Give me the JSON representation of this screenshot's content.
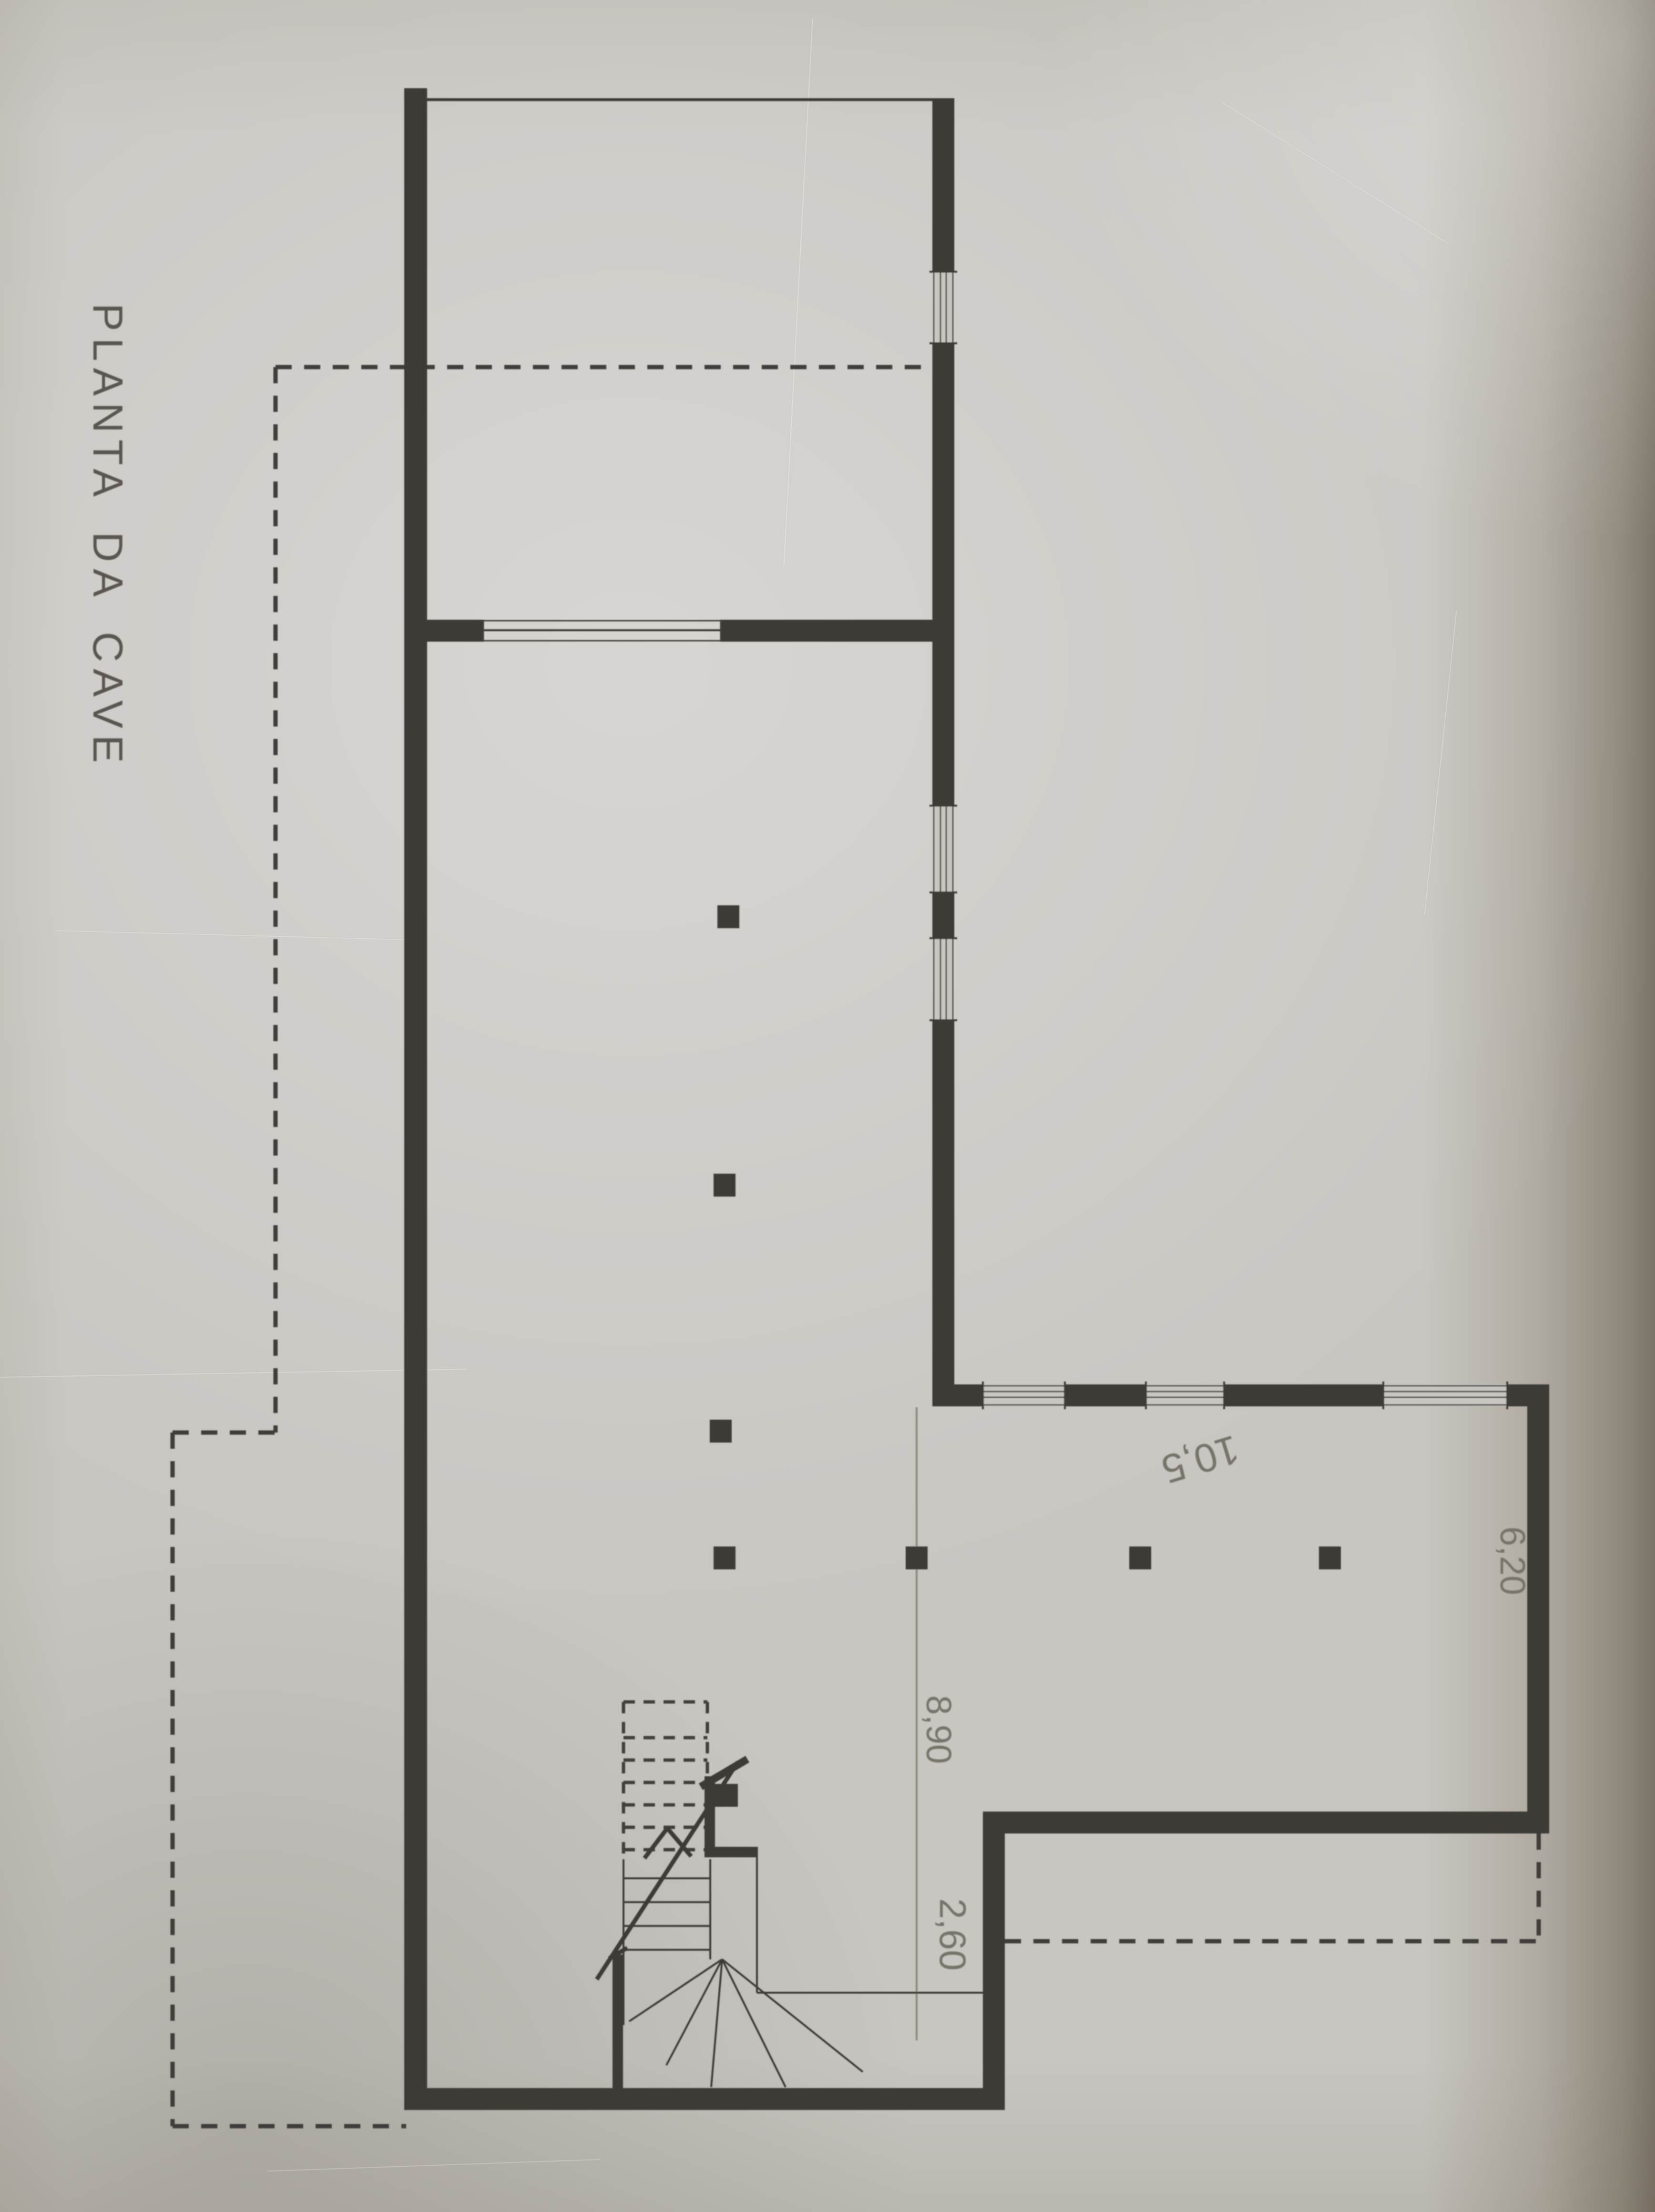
{
  "title": "PLANTA DA CAVE",
  "dimension_labels": {
    "hall_length": "8,90",
    "entry_recess": "2,60",
    "main_room_width": "10,5",
    "main_room_depth": "6,20"
  },
  "colors": {
    "paper": "#c8c6c1",
    "wall_ink": "#3c3a36",
    "pencil_text": "#77736a",
    "pencil_line": "#8e897d",
    "page_edge_shadow": "#80786a"
  },
  "plan_features": {
    "drawing_type": "basement floor plan, scanned photo, rotated 90°",
    "pillar_count": 7,
    "window_opening_count": 6,
    "stair": "winder stair, upper flight shown dashed, with section break line and arrow",
    "dashed_lines": "projected outline beyond walls and overhead-slab edges"
  }
}
